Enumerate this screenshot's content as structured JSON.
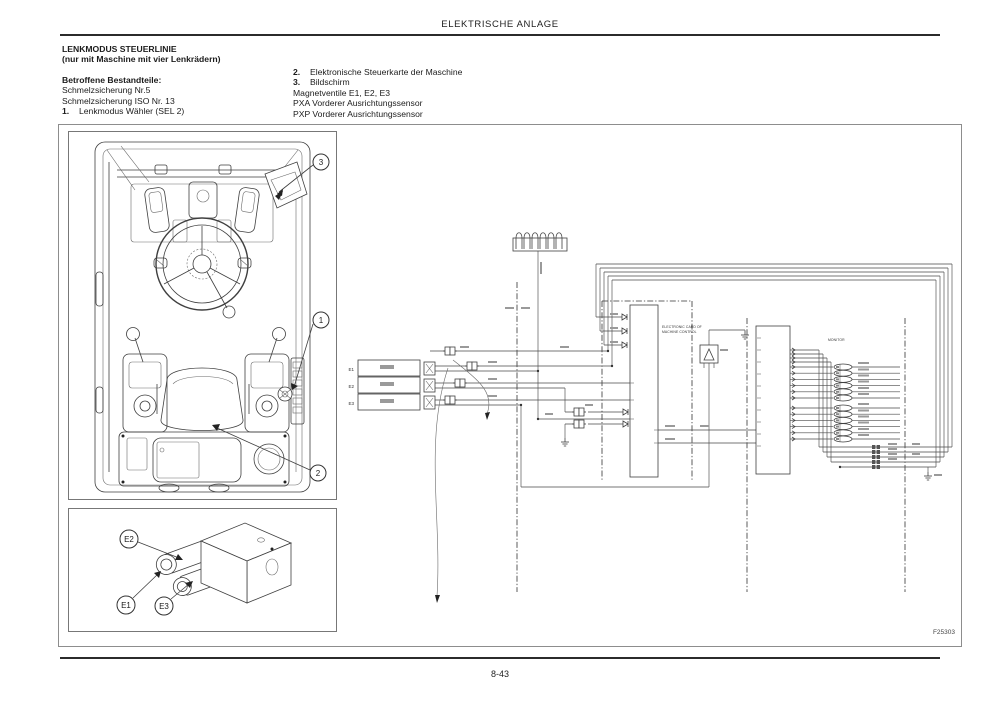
{
  "header": {
    "title": "ELEKTRISCHE ANLAGE"
  },
  "intro": {
    "heading1": "LENKMODUS STEUERLINIE",
    "heading2": "(nur mit Maschine mit vier Lenkrädern)",
    "subheading": "Betroffene Bestandteile:",
    "left_items": [
      "Schmelzsicherung Nr.5",
      "Schmelzsicherung ISO Nr. 13"
    ],
    "item1_num": "1.",
    "item1_label": "Lenkmodus Wähler (SEL 2)",
    "item2_num": "2.",
    "item2_label": "Elektronische Steuerkarte der Maschine",
    "item3_num": "3.",
    "item3_label": "Bildschirm",
    "right_items": [
      "Magnetventile E1, E2, E3",
      "PXA Vorderer Ausrichtungssensor",
      "PXP Vorderer Ausrichtungssensor"
    ]
  },
  "figure": {
    "code": "F25303",
    "cab": {
      "callout1": "1",
      "callout2": "2",
      "callout3": "3"
    },
    "valve": {
      "e1": "E1",
      "e2": "E2",
      "e3": "E3"
    },
    "schematic": {
      "sol1": "E1",
      "sol2": "E2",
      "sol3": "E3",
      "card_label1": "ELECTRONIC CARD OF",
      "card_label2": "MACHINE CONTROL",
      "monitor_label": "MONITOR"
    }
  },
  "footer": {
    "page": "8-43"
  }
}
